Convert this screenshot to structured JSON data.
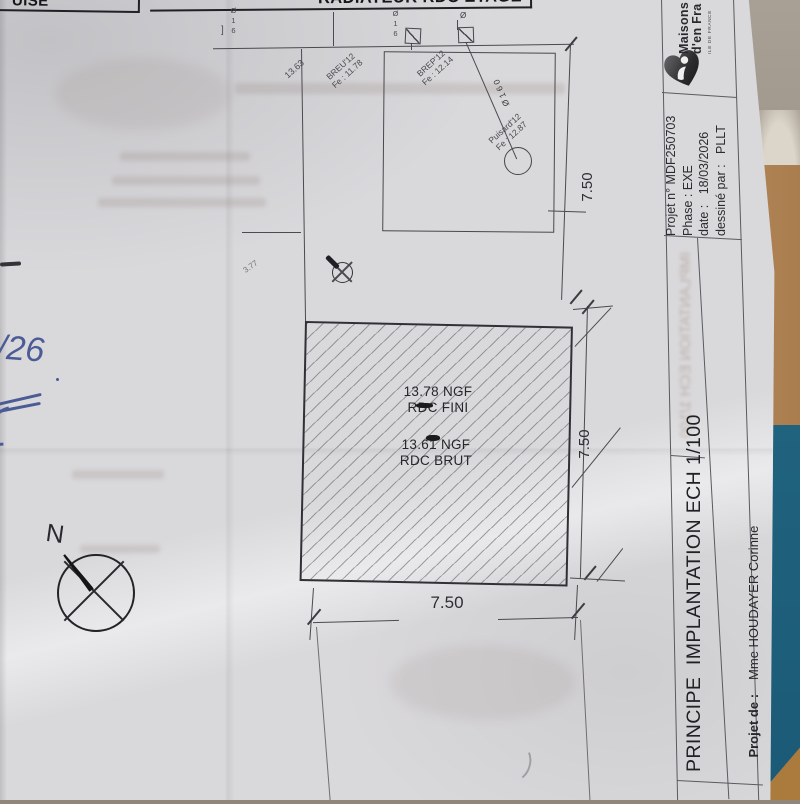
{
  "banner": {
    "left_fragment": "UISE",
    "title": "RADIATEUR RDC ETAGE"
  },
  "plan": {
    "level_1363": "13.63",
    "breu_name": "BREU'12",
    "breu_fe": "Fe : 11.78",
    "brep_name": "BREP'12",
    "brep_fe": "Fe : 12.14",
    "puisard_name": "Puisard'12",
    "puisard_fe": "Fe : 12.87",
    "riser_bracket": "]",
    "riser_left": "Ø16",
    "riser_right": "Ø16",
    "riser_mark": "Ø",
    "pipe_label": "Ø160",
    "offset_377": "3.77",
    "slab_ngf_fini_value": "13.78 NGF",
    "slab_ngf_fini_label": "RDC FINI",
    "slab_ngf_brut_value": "13.61 NGF",
    "slab_ngf_brut_label": "RDC BRUT",
    "dim_top": "7.50",
    "dim_right": "7.50",
    "dim_bottom": "7.50",
    "north": "N"
  },
  "handwriting": {
    "note": "/26"
  },
  "title_block": {
    "brand_line1": "Maisons",
    "brand_line2": "d'en Fra",
    "brand_tagline": "ILE DE FRANCE",
    "project_no": "Projet n° MDF250703",
    "phase": "Phase : EXE",
    "date": "date :   18/03/2026",
    "drawn_by": "dessiné par :   PLLT",
    "drawing_title": "PRINCIPE  IMPLANTATION ECH 1/100",
    "client_label": "Projet de :",
    "client_name": "Mme HOUDAYER Corinne",
    "ghost": "IMPLANTATION ECH 1/100"
  }
}
